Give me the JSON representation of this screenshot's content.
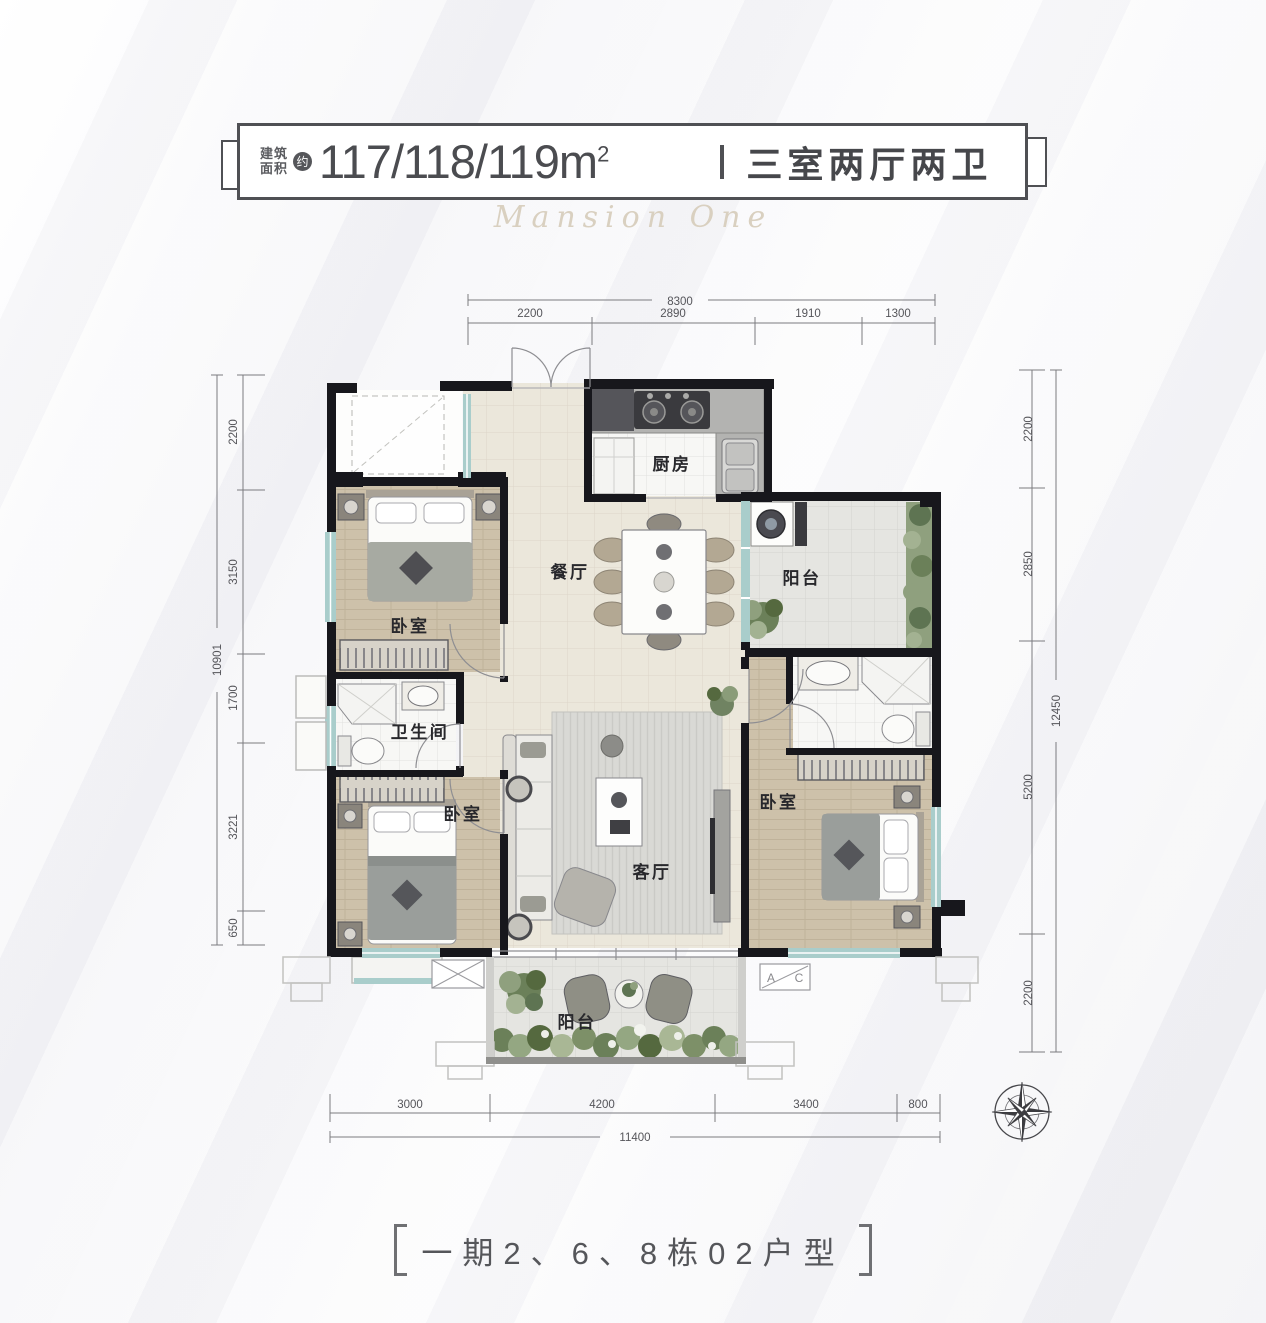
{
  "header": {
    "prefix_line1": "建筑",
    "prefix_line2": "面积",
    "approx_badge": "约",
    "area_value": "117/118/119m",
    "area_exponent": "2",
    "type_text": "三室两厅两卫"
  },
  "watermark": "Mansion One",
  "rooms": {
    "kitchen": "厨房",
    "dining": "餐厅",
    "living": "客厅",
    "bathroom": "卫生间",
    "bedroom_top_left": "卧室",
    "bedroom_bottom_left": "卧室",
    "bedroom_master": "卧室",
    "balcony_right": "阳台",
    "balcony_bottom": "阳台"
  },
  "dims": {
    "top": {
      "total": "8300",
      "seg": [
        "2200",
        "2890",
        "1910",
        "1300"
      ]
    },
    "left": {
      "total": "10901",
      "seg": [
        "2200",
        "3150",
        "1700",
        "3221",
        "650"
      ]
    },
    "right": {
      "total": "12450",
      "seg": [
        "2200",
        "2850",
        "5200",
        "2200"
      ]
    },
    "bottom": {
      "total": "11400",
      "seg": [
        "3000",
        "4200",
        "3400",
        "800"
      ]
    }
  },
  "annotations": {
    "ac_left": "A",
    "ac_right": "C"
  },
  "footer": {
    "text": "一期2、6、8栋02户型"
  },
  "colors": {
    "wall": "#17171c",
    "wood_floor": "#cdc1aa",
    "tile_floor": "#ebe7db",
    "balcony_floor": "#e4e4e0",
    "window": "#a9cdcb",
    "plant_green": "#7d9068",
    "title_text": "#4b4c50",
    "dim_text": "#55555a"
  }
}
